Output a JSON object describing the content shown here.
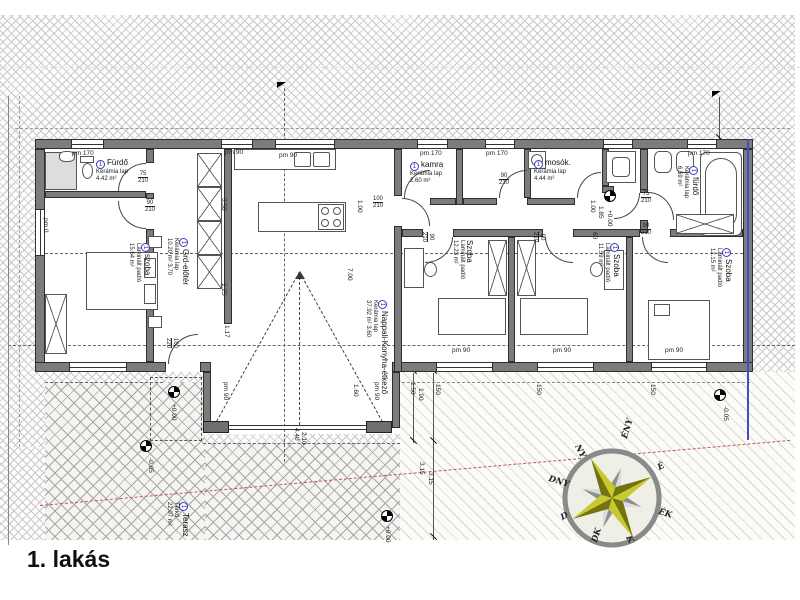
{
  "title": "1. lakás",
  "plan": {
    "rooms": [
      {
        "num": "1",
        "name": "Fürdő",
        "floor": "Kerámia lap",
        "area": "4.42 m²",
        "orient": "h",
        "x": 96,
        "y": 158
      },
      {
        "num": "1",
        "name": "szoba",
        "floor": "Laminált padló",
        "area": "15.64 m²",
        "orient": "v",
        "x": 152,
        "y": 243
      },
      {
        "num": "1",
        "name": "Grd-előtér",
        "floor": "Kerámia lap",
        "area": "10.20 m²  3.70",
        "orient": "v",
        "x": 190,
        "y": 238
      },
      {
        "num": "1",
        "name": "Nappali-Konyha-étkező",
        "floor": "Kerámia lap",
        "area": "37.92 m²  3.60",
        "orient": "v",
        "x": 389,
        "y": 300
      },
      {
        "num": "1",
        "name": "kamra",
        "floor": "Kerámia lap",
        "area": "2.60 m²",
        "orient": "h",
        "x": 410,
        "y": 160
      },
      {
        "num": "1",
        "name": "mosók.",
        "floor": "Kerámia lap",
        "area": "4.44 m²",
        "orient": "h",
        "x": 534,
        "y": 158
      },
      {
        "num": "1",
        "name": "fürdő",
        "floor": "Kerámia lap",
        "area": "6.59 m²",
        "orient": "v",
        "x": 700,
        "y": 166
      },
      {
        "num": "",
        "name": "Szoba",
        "floor": "Laminált padló",
        "area": "12.23 m²",
        "orient": "v",
        "x": 474,
        "y": 240
      },
      {
        "num": "1",
        "name": "Szoba",
        "floor": "Laminált padló",
        "area": "11.59 m²",
        "orient": "v",
        "x": 621,
        "y": 243
      },
      {
        "num": "1",
        "name": "Szoba",
        "floor": "Laminált padló",
        "area": "12.15 m²",
        "orient": "v",
        "x": 733,
        "y": 248
      },
      {
        "num": "1",
        "name": "Terasz",
        "floor": "Térkő",
        "area": "22.07 m²",
        "orient": "v",
        "x": 190,
        "y": 502
      }
    ],
    "labels": [
      {
        "text": "pm 170",
        "x": 72,
        "y": 151,
        "rot": 0
      },
      {
        "text": "pm 90",
        "x": 225,
        "y": 150,
        "rot": 0
      },
      {
        "text": "pm 90",
        "x": 279,
        "y": 153,
        "rot": 0
      },
      {
        "text": "pm 170",
        "x": 420,
        "y": 151,
        "rot": 0
      },
      {
        "text": "pm 170",
        "x": 486,
        "y": 151,
        "rot": 0
      },
      {
        "text": "pm 170",
        "x": 688,
        "y": 151,
        "rot": 0
      },
      {
        "text": "pm 90",
        "x": 452,
        "y": 348,
        "rot": 0
      },
      {
        "text": "pm 90",
        "x": 553,
        "y": 348,
        "rot": 0
      },
      {
        "text": "pm 90",
        "x": 665,
        "y": 348,
        "rot": 0
      },
      {
        "text": "pm 90",
        "x": 228,
        "y": 382,
        "rot": 90
      },
      {
        "text": "pm 90",
        "x": 379,
        "y": 382,
        "rot": 90
      },
      {
        "text": "pm 0",
        "x": 48,
        "y": 218,
        "rot": 90
      },
      {
        "text": "3.58",
        "x": 226,
        "y": 198,
        "rot": 90
      },
      {
        "text": "1.25",
        "x": 226,
        "y": 283,
        "rot": 90
      },
      {
        "text": "1.17",
        "x": 229,
        "y": 325,
        "rot": 90
      },
      {
        "text": "7.00",
        "x": 352,
        "y": 268,
        "rot": 90
      },
      {
        "text": "1.00",
        "x": 362,
        "y": 200,
        "rot": 90
      },
      {
        "text": "1.60",
        "x": 358,
        "y": 384,
        "rot": 90
      },
      {
        "text": "1.50",
        "x": 415,
        "y": 382,
        "rot": 90
      },
      {
        "text": "1.90",
        "x": 423,
        "y": 388,
        "rot": 90
      },
      {
        "text": "3.15",
        "x": 424,
        "y": 462,
        "rot": 90
      },
      {
        "text": "3.15",
        "x": 433,
        "y": 472,
        "rot": 90
      },
      {
        "text": "4.40",
        "x": 299,
        "y": 428,
        "rot": 90
      },
      {
        "text": "2.10",
        "x": 306,
        "y": 432,
        "rot": 90
      },
      {
        "text": "1.00",
        "x": 595,
        "y": 200,
        "rot": 90
      },
      {
        "text": "1.85",
        "x": 603,
        "y": 206,
        "rot": 90
      },
      {
        "text": "60",
        "x": 597,
        "y": 232,
        "rot": 90
      },
      {
        "text": "150",
        "x": 440,
        "y": 384,
        "rot": 90
      },
      {
        "text": "150",
        "x": 541,
        "y": 384,
        "rot": 90
      },
      {
        "text": "150",
        "x": 655,
        "y": 384,
        "rot": 90
      },
      {
        "text": "+0.00",
        "x": 612,
        "y": 210,
        "rot": 90
      },
      {
        "text": "+0.00",
        "x": 176,
        "y": 404,
        "rot": 90
      },
      {
        "text": "+0.00",
        "x": 390,
        "y": 526,
        "rot": 90
      },
      {
        "text": "-0.05",
        "x": 728,
        "y": 406,
        "rot": 90
      },
      {
        "text": "-0.05",
        "x": 153,
        "y": 458,
        "rot": 90
      }
    ],
    "door_sizes": [
      {
        "top": "75",
        "bot": "210",
        "x": 138,
        "y": 171,
        "rot": 0
      },
      {
        "top": "90",
        "bot": "210",
        "x": 145,
        "y": 200,
        "rot": 0
      },
      {
        "top": "100",
        "bot": "210",
        "x": 373,
        "y": 196,
        "rot": 0
      },
      {
        "top": "90",
        "bot": "210",
        "x": 499,
        "y": 173,
        "rot": 0
      },
      {
        "top": "90",
        "bot": "210",
        "x": 434,
        "y": 232,
        "rot": 90
      },
      {
        "top": "90",
        "bot": "210",
        "x": 545,
        "y": 232,
        "rot": 90
      },
      {
        "top": "75",
        "bot": "210",
        "x": 641,
        "y": 191,
        "rot": 0
      },
      {
        "top": "90",
        "bot": "210",
        "x": 641,
        "y": 223,
        "rot": 0
      },
      {
        "top": "100",
        "bot": "220",
        "x": 178,
        "y": 338,
        "rot": 90
      }
    ],
    "compass": {
      "directions": [
        {
          "text": "É",
          "x": 656,
          "y": 464,
          "rot": -28
        },
        {
          "text": "ÉK",
          "x": 660,
          "y": 507,
          "rot": 17
        },
        {
          "text": "K",
          "x": 632,
          "y": 534,
          "rot": 62
        },
        {
          "text": "DK",
          "x": 590,
          "y": 541,
          "rot": -73
        },
        {
          "text": "D",
          "x": 559,
          "y": 514,
          "rot": -28
        },
        {
          "text": "DNY",
          "x": 550,
          "y": 474,
          "rot": 17
        },
        {
          "text": "NY",
          "x": 581,
          "y": 443,
          "rot": 62
        },
        {
          "text": "ÉNY",
          "x": 620,
          "y": 437,
          "rot": -73
        }
      ]
    }
  }
}
